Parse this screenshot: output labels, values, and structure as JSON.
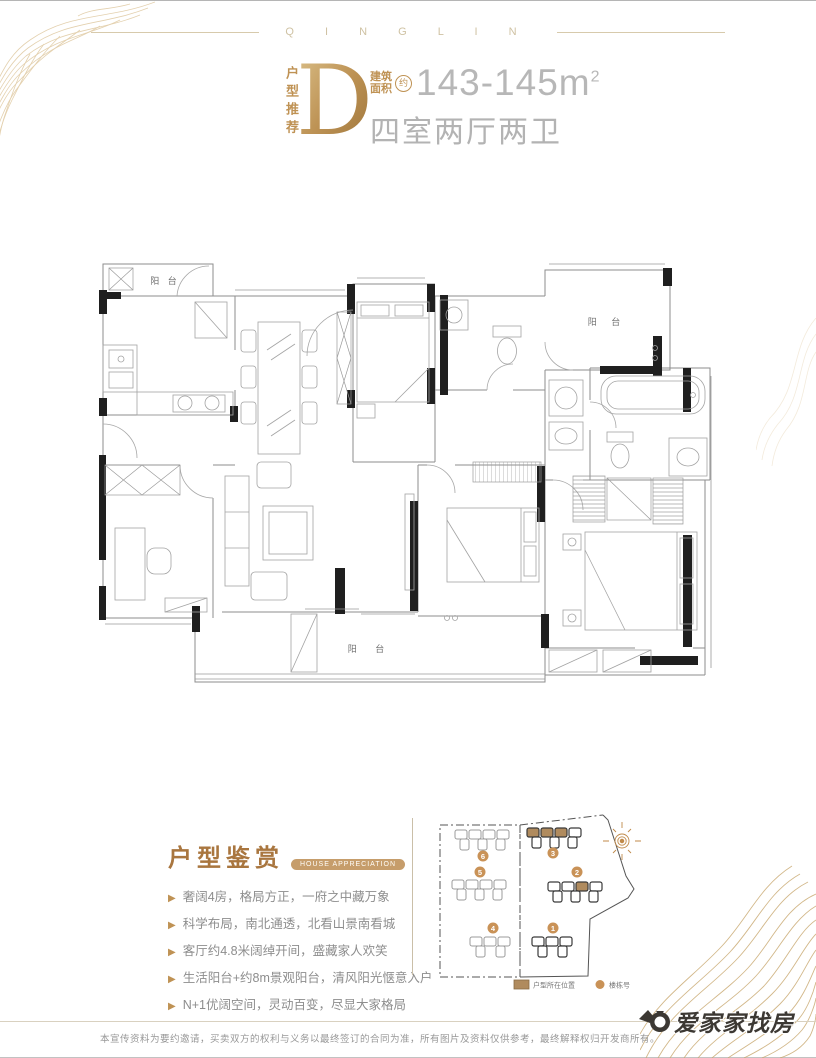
{
  "brand_band": {
    "letters": "Q I N G L I N"
  },
  "header": {
    "recommend_label": "户型推荐",
    "type_letter": "D",
    "area_label_line1": "建筑",
    "area_label_line2": "面积",
    "approx_mark": "约",
    "area_value": "143-145m",
    "area_exponent": "2",
    "layout_text": "四室两厅两卫"
  },
  "floor_plan": {
    "balcony_top_left": "阳 台",
    "balcony_top_right": "阳 台",
    "balcony_bottom": "阳    台"
  },
  "appreciation": {
    "title": "户型鉴赏",
    "badge": "HOUSE APPRECIATION",
    "bullets": [
      "奢阔4房，格局方正，一府之中藏万象",
      "科学布局，南北通透，北看山景南看城",
      "客厅约4.8米阔绰开间，盛藏家人欢笑",
      "生活阳台+约8m景观阳台，清风阳光惬意入户",
      "N+1优阔空间，灵动百变，尽显大家格局"
    ]
  },
  "site_plan": {
    "building_numbers": {
      "b1": "1",
      "b2": "2",
      "b3": "3",
      "b4": "4",
      "b5": "5",
      "b6": "6"
    },
    "legend_unit_label": "户型所在位置",
    "legend_building_label": "楼栋号"
  },
  "footer": {
    "disclaimer": "本宣传资料为要约邀请，买卖双方的权利与义务以最终签订的合同为准，所有图片及资料仅供参考，最终解释权归开发商所有。",
    "brand_name": "爱家家找房"
  },
  "colors": {
    "gold_accent": "#bf9254",
    "badge_tan": "#c69d6b",
    "highlight_unit": "#b08b5e",
    "number_circle": "#c99257",
    "gray_text": "#8d8d8d",
    "light_gray_text": "#b5b5b5",
    "wall_black": "#1f1f1f"
  }
}
